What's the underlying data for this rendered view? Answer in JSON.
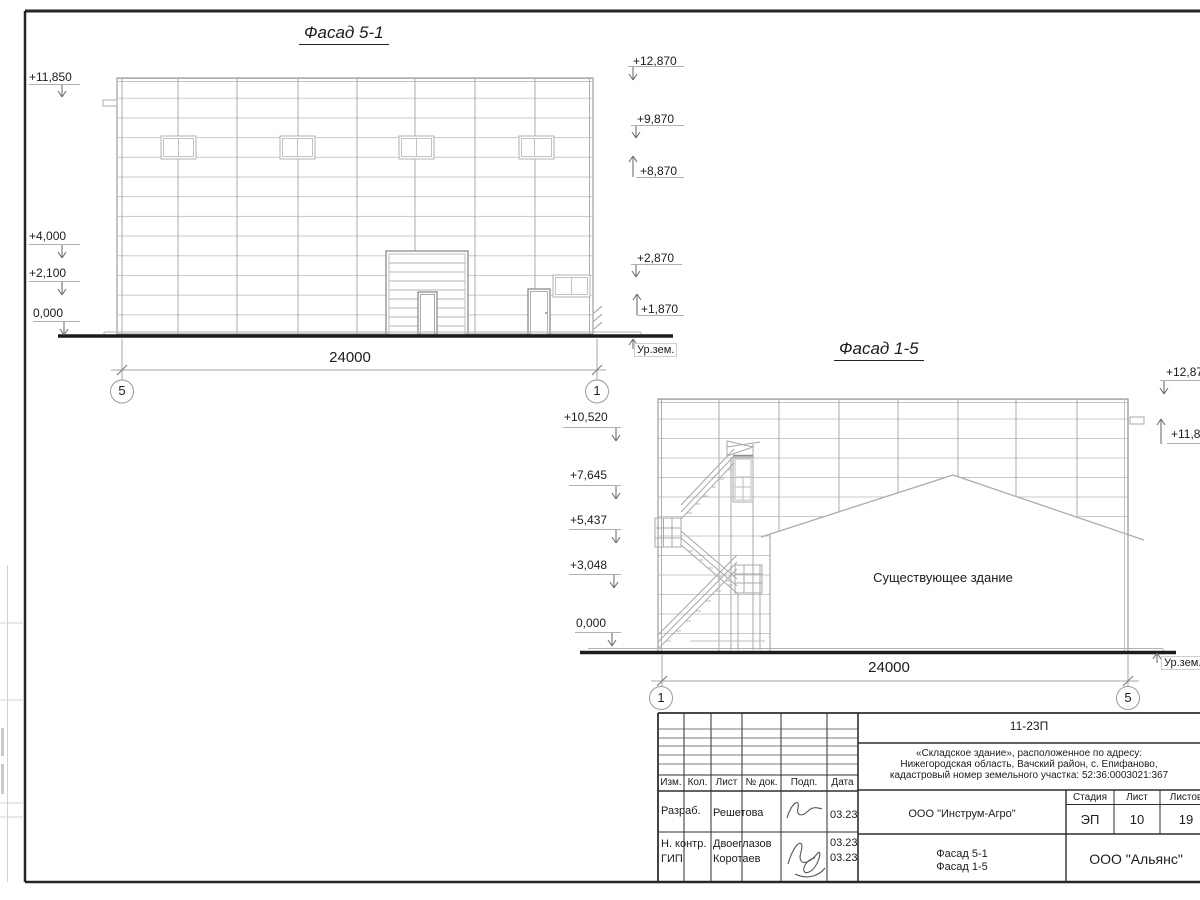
{
  "facade_5_1": {
    "title": "Фасад 5-1",
    "dimension_label": "24000",
    "axis_start": "5",
    "axis_end": "1",
    "ground_label": "Ур.зем.",
    "marks_left": [
      "+11,850",
      "+4,000",
      "+2,100",
      "0,000"
    ],
    "marks_right": [
      "+12,870",
      "+9,870",
      "+8,870",
      "+2,870",
      "+1,870"
    ]
  },
  "facade_1_5": {
    "title": "Фасад 1-5",
    "dimension_label": "24000",
    "axis_start": "1",
    "axis_end": "5",
    "ground_label": "Ур.зем.",
    "existing_building_label": "Существующее здание",
    "marks_left": [
      "+10,520",
      "+7,645",
      "+5,437",
      "+3,048",
      "0,000"
    ],
    "marks_right": [
      "+12,870",
      "+11,850"
    ]
  },
  "title_block": {
    "document_code": "11-23П",
    "address_lines": [
      "«Складское здание», расположенное по адресу:",
      "Нижегородская область, Вачский район, с. Епифаново,",
      "кадастровый номер земельного участка: 52:36:0003021:367"
    ],
    "columns": [
      "Изм.",
      "Кол.",
      "Лист",
      "№ док.",
      "Подп.",
      "Дата"
    ],
    "rows": [
      {
        "role": "Разраб.",
        "name": "Решетова",
        "date": "03.23"
      },
      {
        "role": "Н. контр.",
        "name": "Двоеглазов",
        "date": "03.23"
      },
      {
        "role": "ГИП",
        "name": "Коротаев",
        "date": "03.23"
      }
    ],
    "client": "ООО \"Инструм-Агро\"",
    "stage_header": [
      "Стадия",
      "Лист",
      "Листов"
    ],
    "stage": "ЭП",
    "sheet_number": "10",
    "sheet_total": "19",
    "drawing_titles": [
      "Фасад 5-1",
      "Фасад 1-5"
    ],
    "organization": "ООО \"Альянс\""
  }
}
